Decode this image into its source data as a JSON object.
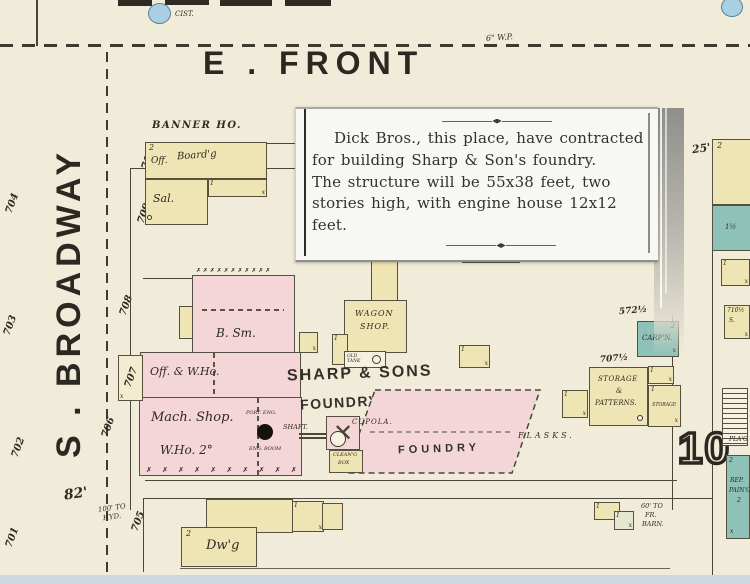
{
  "streets": {
    "front": "E . FRONT",
    "broadway": "S . BROADWAY"
  },
  "clipping": {
    "text": "Dick Bros., this place, have contracted\nfor building Sharp & Son's foundry.\nThe structure will be 55x38 feet, two\nstories high, with engine house 12x12\nfeet."
  },
  "labels": {
    "cistern": "CIST.",
    "water_pipe": "6\" W.P.",
    "banner_house": "BANNER HO.",
    "block_number": "10",
    "dim25": "25'",
    "dim82": "82'",
    "hyd1": "100' TO",
    "hyd2": "HYD.",
    "barn1": "60' TO",
    "barn2": "FR.",
    "barn3": "BARN.",
    "flasks": "FLASKS.",
    "sharp1": "SHARP & SONS",
    "sharp2": "FOUNDRY & MACH. SHOP.",
    "shaft": "SHAFT.",
    "cupola": "CUPOLA.",
    "clean1": "CLEAN'G",
    "clean2": "BOX",
    "old_tank": "OLD TANK",
    "port_eng": "PORT. ENG.",
    "eng_room": "ENG. ROOM",
    "addr572": "572½",
    "addr707h": "707½",
    "addr710h": "710½",
    "planing": "PLA'G"
  },
  "buildings": {
    "banner": {
      "story": "2",
      "office": "Off.",
      "boarding": "Board'g",
      "saloon": "Sal."
    },
    "blacksmith": "B. Sm.",
    "office_warehouse": "Off. & W.Ho.",
    "machine_shop_line1": "Mach. Shop.",
    "machine_shop_line2": "W.Ho. 2°",
    "wagon_line1": "WAGON",
    "wagon_line2": "SHOP.",
    "foundry": "FOUNDRY",
    "storage_line1": "STORAGE",
    "storage_line2": "&",
    "storage_line3": "PATTERNS.",
    "storage_east": "STORAGE",
    "carpenter": "CARP'N.",
    "dwelling": "Dw'g",
    "repair_line1": "REP.",
    "repair_line2": "PAIN'G",
    "teal_small": "1½",
    "right_s": "S."
  },
  "house_numbers": {
    "west": [
      "704",
      "703",
      "702",
      "701"
    ],
    "east": [
      "710",
      "709",
      "708",
      "707",
      "706",
      "705"
    ]
  },
  "symbols": {
    "one": "1",
    "two": "2",
    "x": "x",
    "xmark": "✕",
    "hatch": "✗ ✗ ✗ ✗ ✗ ✗ ✗ ✗ ✗ ✗ ✗"
  },
  "colors": {
    "paper": "#f1ecda",
    "building_yellow": "#efe4b4",
    "building_pink": "#f4d5d8",
    "building_teal": "#8ec1b8",
    "water_blue": "#a9cfe2",
    "ink": "#2b2822"
  }
}
